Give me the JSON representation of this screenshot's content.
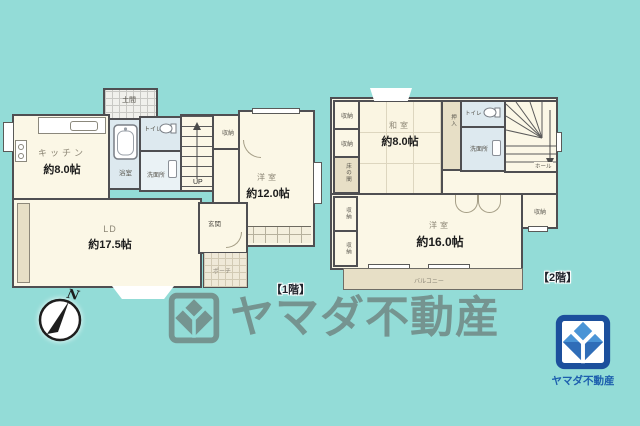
{
  "colors": {
    "background": "#93dcd7",
    "wall": "#4f4f52",
    "room_fill": "#fbf7e6",
    "wet_fill": "#dde9ef",
    "tan_fill": "#e7dfc6",
    "logo_blue_dark": "#1c4f9c",
    "logo_blue_light": "#4a94d6",
    "logo_blue_deep": "#2f6db8",
    "watermark_gray": "#6e837f"
  },
  "floor1": {
    "caption": "【1階】",
    "doma": "土間",
    "kitchen_name": "キッチン",
    "kitchen_size": "約8.0帖",
    "bath": "浴室",
    "toilet": "トイレ",
    "washroom": "洗面所",
    "stairs_label": "UP",
    "closet": "収納",
    "bedroom_name": "洋室",
    "bedroom_size": "約12.0帖",
    "living_name": "LD",
    "living_size": "約17.5帖",
    "entrance": "玄関",
    "porch": "ポーチ"
  },
  "floor2": {
    "caption": "【2階】",
    "closet_a": "収納",
    "closet_b": "収納",
    "tokonoma": "床の間",
    "tatami_name": "和室",
    "tatami_size": "約8.0帖",
    "oshiire": "押入",
    "toilet": "トイレ",
    "washroom": "洗面所",
    "hall": "ホール",
    "closet_left1": "収納",
    "closet_left2": "収納",
    "bedroom_name": "洋室",
    "bedroom_size": "約16.0帖",
    "closet_right": "収納",
    "balcony": "バルコニー"
  },
  "compass": {
    "north_label": "N"
  },
  "watermark": {
    "company": "ヤマダ不動産"
  },
  "logo": {
    "company": "ヤマダ不動産"
  }
}
